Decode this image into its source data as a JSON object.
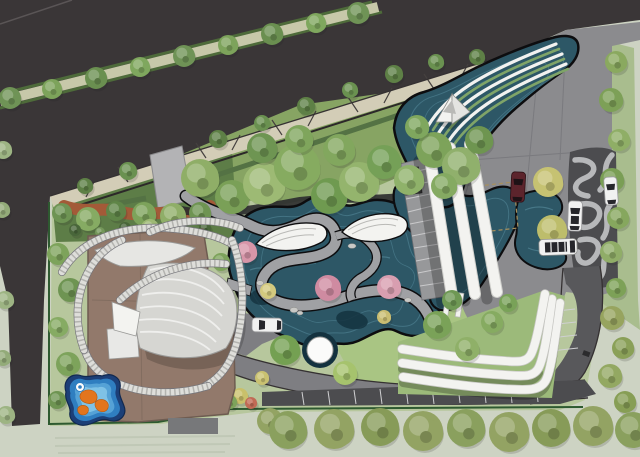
{
  "meta": {
    "kind": "landscape-architecture-site-plan-rendering",
    "width": 640,
    "height": 457
  },
  "palette": {
    "road": "#3a3637",
    "road_corner_line": "#5a5556",
    "grass_outside": "#cdd3c3",
    "lawn": "#b7c79d",
    "lawn_bright": "#a9c583",
    "woodland": "#87a463",
    "hedge_bed": "#5d7d47",
    "hedge_line": "#547244",
    "sidewalk": "#d3cdb7",
    "hatch": "#45403f",
    "median_path": "#c7c8a9",
    "median_edge": "#4e6b3a",
    "water": "#2d5766",
    "water_deep": "#14323f",
    "water_edge": "#0d0d0f",
    "plaza": "#8b8b8e",
    "path_gray": "#a0a1a4",
    "road_sweep": "#7e7e82",
    "road_side": "#58585b",
    "parking": "#4c4c4f",
    "maze_base": "#4c4c4f",
    "maze_band": "#b7b8ba",
    "structure_white": "#f3f3f0",
    "steps_gray": "#97989a",
    "kiosk_dark": "#3c3c3e",
    "roof_brown": "#92796b",
    "roof_edge": "#6e5c51",
    "deck_gray": "#77787a",
    "red_path": "#a35a38",
    "fence_green": "#2e5a30",
    "terrace_green": "#7fa468",
    "play_navy": "#1c3f77",
    "play_blue": "#2f7ec0",
    "play_light": "#55a2d6",
    "play_core": "#7fc2e6",
    "play_orange": "#e2751d",
    "car_maroon": "#5c242c",
    "car_white": "#f1f1f1",
    "car_glass": "#26262b",
    "boulder": "#c9c9c6"
  },
  "cars": {
    "maroon_car": {
      "transform": "translate(518,187) rotate(3)"
    },
    "white_car_plaza": {
      "transform": "translate(575,216) rotate(2)"
    },
    "white_car_east": {
      "transform": "translate(611,191) rotate(-4)"
    },
    "shuttle_bus": {
      "transform": "translate(558,247) rotate(-2)"
    },
    "white_car_drive": {
      "transform": "translate(267,325) rotate(-89)"
    }
  },
  "trees": [
    [
      10,
      98,
      11,
      "#6f9356"
    ],
    [
      52,
      89,
      10,
      "#7da35b"
    ],
    [
      96,
      78,
      11,
      "#6a8f50"
    ],
    [
      140,
      67,
      10,
      "#7fa75e"
    ],
    [
      184,
      56,
      11,
      "#6f9356"
    ],
    [
      228,
      45,
      10,
      "#7da35b"
    ],
    [
      272,
      34,
      11,
      "#6a8f50"
    ],
    [
      316,
      23,
      10,
      "#7fa75e"
    ],
    [
      358,
      13,
      11,
      "#6f9356"
    ],
    [
      85,
      186,
      8,
      "#5e8046"
    ],
    [
      128,
      171,
      9,
      "#6a9150"
    ],
    [
      218,
      139,
      9,
      "#5e8046"
    ],
    [
      262,
      123,
      8,
      "#6a9150"
    ],
    [
      306,
      106,
      9,
      "#5e8046"
    ],
    [
      350,
      90,
      8,
      "#6a9150"
    ],
    [
      394,
      74,
      9,
      "#5e8046"
    ],
    [
      436,
      62,
      8,
      "#6a9150"
    ],
    [
      477,
      57,
      8,
      "#5e8046"
    ],
    [
      3,
      150,
      9,
      "#9db483"
    ],
    [
      2,
      210,
      8,
      "#93ab79"
    ],
    [
      5,
      300,
      9,
      "#9db483"
    ],
    [
      3,
      358,
      8,
      "#93ab79"
    ],
    [
      6,
      415,
      9,
      "#9db483"
    ],
    [
      62,
      213,
      10,
      "#6e9454"
    ],
    [
      88,
      219,
      12,
      "#86ab63"
    ],
    [
      116,
      211,
      10,
      "#5f8548"
    ],
    [
      144,
      214,
      12,
      "#7da35b"
    ],
    [
      173,
      216,
      13,
      "#8fae68"
    ],
    [
      200,
      213,
      11,
      "#6e9452"
    ],
    [
      150,
      228,
      9,
      "#9db974"
    ],
    [
      58,
      254,
      11,
      "#7da35b"
    ],
    [
      70,
      290,
      12,
      "#6e9452"
    ],
    [
      58,
      327,
      10,
      "#86ab63"
    ],
    [
      68,
      364,
      12,
      "#7da35b"
    ],
    [
      57,
      400,
      9,
      "#6e9452"
    ],
    [
      75,
      230,
      6,
      "#49663a"
    ],
    [
      100,
      232,
      5,
      "#74975a"
    ],
    [
      125,
      228,
      6,
      "#49663a"
    ],
    [
      180,
      230,
      5,
      "#74975a"
    ],
    [
      205,
      228,
      6,
      "#49663a"
    ],
    [
      200,
      178,
      19,
      "#8fae67"
    ],
    [
      232,
      197,
      17,
      "#7aa057"
    ],
    [
      264,
      184,
      21,
      "#9dba74"
    ],
    [
      297,
      167,
      23,
      "#86ab60"
    ],
    [
      329,
      196,
      18,
      "#6f9a50"
    ],
    [
      359,
      182,
      20,
      "#94b46d"
    ],
    [
      299,
      139,
      14,
      "#7fa55c"
    ],
    [
      262,
      148,
      15,
      "#6e9552"
    ],
    [
      339,
      150,
      16,
      "#82a75e"
    ],
    [
      384,
      162,
      17,
      "#75a057"
    ],
    [
      409,
      180,
      15,
      "#8fb26a"
    ],
    [
      434,
      150,
      18,
      "#7da35a"
    ],
    [
      461,
      166,
      19,
      "#90b06c"
    ],
    [
      479,
      140,
      14,
      "#6e9550"
    ],
    [
      417,
      127,
      12,
      "#7fa75e"
    ],
    [
      444,
      186,
      13,
      "#85aa62"
    ],
    [
      221,
      262,
      9,
      "#7da35b"
    ],
    [
      227,
      300,
      8,
      "#6e9452"
    ],
    [
      219,
      338,
      8,
      "#86a963"
    ],
    [
      246,
      252,
      11,
      "#d795a8"
    ],
    [
      328,
      288,
      13,
      "#cf8ba1"
    ],
    [
      389,
      287,
      12,
      "#d89eb0"
    ],
    [
      268,
      291,
      8,
      "#d3c97e"
    ],
    [
      384,
      317,
      7,
      "#c9bd72"
    ],
    [
      285,
      350,
      15,
      "#74a052"
    ],
    [
      345,
      373,
      12,
      "#a6c36d"
    ],
    [
      437,
      325,
      14,
      "#7aa258"
    ],
    [
      467,
      349,
      12,
      "#8fb068"
    ],
    [
      452,
      300,
      10,
      "#6e9854"
    ],
    [
      492,
      322,
      11,
      "#86ab61"
    ],
    [
      508,
      303,
      9,
      "#79a258"
    ],
    [
      548,
      182,
      15,
      "#c6c272"
    ],
    [
      552,
      230,
      15,
      "#bdbd6b"
    ],
    [
      616,
      62,
      11,
      "#8aa95f"
    ],
    [
      611,
      100,
      12,
      "#7da057"
    ],
    [
      619,
      140,
      11,
      "#8fae66"
    ],
    [
      612,
      180,
      12,
      "#7a9e55"
    ],
    [
      618,
      218,
      11,
      "#86a75e"
    ],
    [
      611,
      252,
      11,
      "#90ad68"
    ],
    [
      616,
      288,
      10,
      "#7da157"
    ],
    [
      612,
      318,
      12,
      "#97a45f"
    ],
    [
      623,
      348,
      11,
      "#8aa058"
    ],
    [
      610,
      376,
      12,
      "#93a862"
    ],
    [
      625,
      402,
      11,
      "#879e55"
    ],
    [
      636,
      428,
      12,
      "#8aa058"
    ],
    [
      270,
      421,
      13,
      "#93a363"
    ],
    [
      288,
      430,
      19,
      "#8aa05e"
    ],
    [
      334,
      429,
      20,
      "#93a363"
    ],
    [
      380,
      427,
      19,
      "#879b58"
    ],
    [
      423,
      431,
      20,
      "#93a363"
    ],
    [
      466,
      428,
      19,
      "#8aa05e"
    ],
    [
      509,
      432,
      20,
      "#93a363"
    ],
    [
      551,
      428,
      19,
      "#879b58"
    ],
    [
      593,
      426,
      20,
      "#93a363"
    ],
    [
      633,
      430,
      18,
      "#8aa05e"
    ],
    [
      240,
      396,
      8,
      "#c9c06a"
    ],
    [
      251,
      403,
      6,
      "#c06a55"
    ],
    [
      230,
      402,
      7,
      "#7da35b"
    ],
    [
      135,
      373,
      9,
      "#86ab63"
    ],
    [
      262,
      378,
      7,
      "#c9c171"
    ]
  ]
}
